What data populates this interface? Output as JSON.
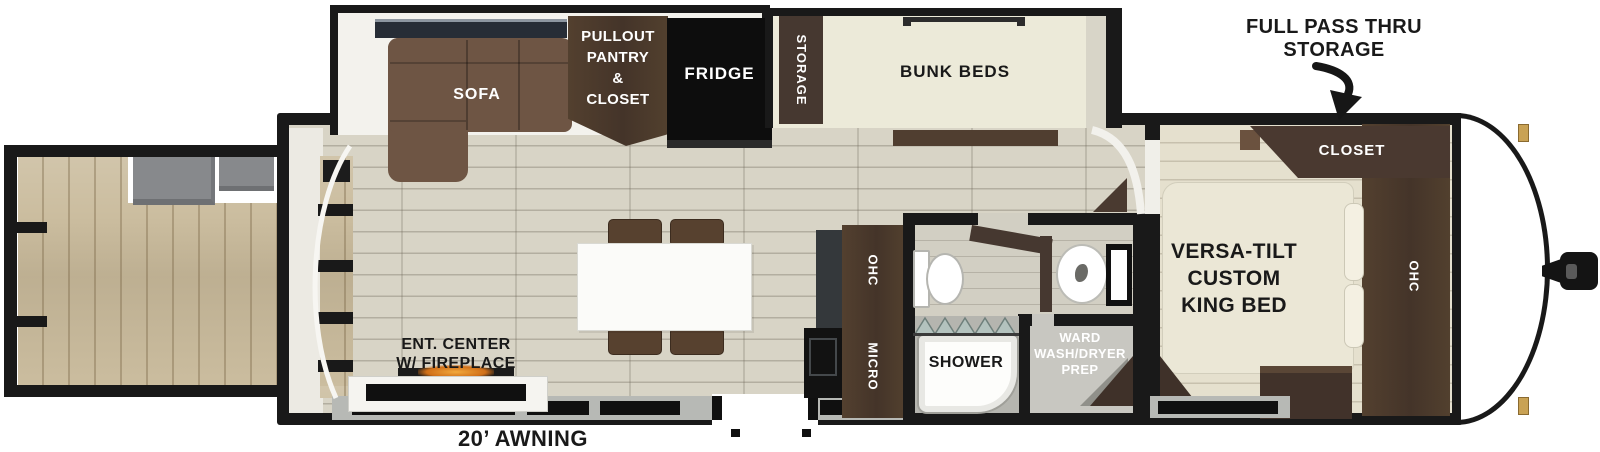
{
  "title": "Travel trailer floorplan",
  "colors": {
    "wall": "#191919",
    "dark_wood": "#4a3a2f",
    "sofa_brown": "#6e5544",
    "cream": "#ebe7d6",
    "floor_main": "#d8d4c6",
    "floor_bedroom": "#e5e0ce",
    "deck_wood": "#cbbd9f",
    "fridge_black": "#0d0d0d",
    "fireplace_glow": "#e8932a",
    "shower_glass": "#b3c2be",
    "hinge_gold": "#c9a254"
  },
  "annotations": {
    "pass_thru_line1": "FULL PASS THRU",
    "pass_thru_line2": "STORAGE",
    "awning": "20’ AWNING"
  },
  "living_area": {
    "sofa": "SOFA",
    "pantry_line1": "PULLOUT",
    "pantry_line2": "PANTRY",
    "pantry_line3": "&",
    "pantry_line4": "CLOSET",
    "fridge": "FRIDGE",
    "ent_center_line1": "ENT. CENTER",
    "ent_center_line2": "W/ FIREPLACE"
  },
  "bunk_room": {
    "storage": "STORAGE",
    "bunks": "BUNK BEDS"
  },
  "kitchen": {
    "ohc": "OHC",
    "micro": "MICRO"
  },
  "bathroom": {
    "shower": "SHOWER",
    "ward_line1": "WARD",
    "ward_line2": "WASH/DRYER",
    "ward_line3": "PREP"
  },
  "bedroom": {
    "closet": "CLOSET",
    "bed_line1": "VERSA-TILT",
    "bed_line2": "CUSTOM",
    "bed_line3": "KING BED",
    "ohc": "OHC"
  }
}
